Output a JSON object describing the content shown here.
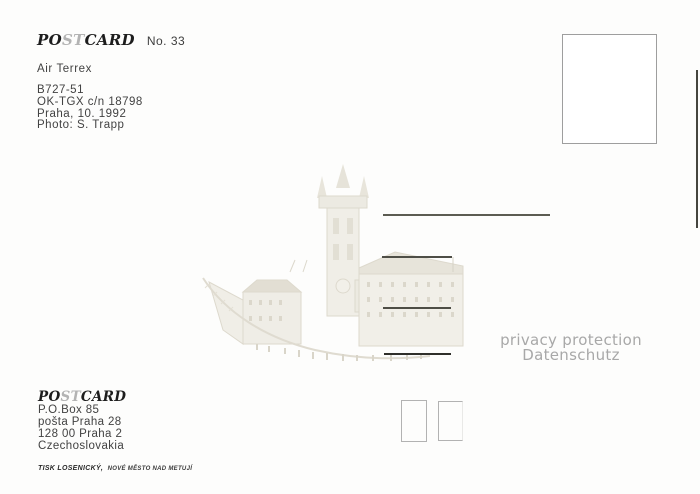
{
  "card": {
    "logo": {
      "p1": "PO",
      "p2": "ST",
      "p3": "CARD"
    },
    "number": "No. 33",
    "airline": "Air Terrex",
    "details": [
      "B727-51",
      "OK-TGX c/n 18798",
      "Praha, 10. 1992",
      "Photo: S. Trapp"
    ],
    "privacy": {
      "line1": "privacy protection",
      "line2": "Datenschutz"
    },
    "publisher": {
      "logo": {
        "p1": "PO",
        "p2": "ST",
        "p3": "CARD"
      },
      "address": [
        "P.O.Box 85",
        "pošta Praha 28",
        "128 00 Praha 2",
        "Czechoslovakia"
      ],
      "printer_name": "TISK LOSENICKÝ,",
      "printer_place": "NOVÉ MĚSTO NAD METUJÍ"
    },
    "watermark_subject": "prague-old-town-hall-sketch",
    "colors": {
      "ink": "#3c3c3c",
      "logo_gray": "#b3b3b3",
      "address_line": "#4e4e46",
      "privacy_gray": "#a8a8a8",
      "stamp_border": "#9e9e9e",
      "sketch_tone": "#ddd9cd"
    }
  }
}
